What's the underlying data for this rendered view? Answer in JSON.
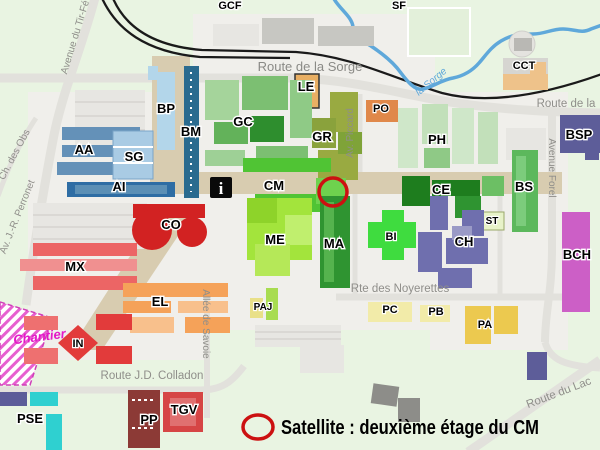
{
  "colors": {
    "grass": "#e9f4e2",
    "ground": "#f0efeb",
    "road": "#e2e1dc",
    "esplanade": "#d8ccb0",
    "railway": "#1a1a1a",
    "river": "#5fa8da",
    "marker": "#cc1111",
    "chantier": "#e318c8"
  },
  "buildings": {
    "GCF": {
      "label": "GCF"
    },
    "SF": {
      "label": "SF"
    },
    "CCT": {
      "label": "CCT",
      "color": "#eec28a"
    },
    "BP": {
      "label": "BP",
      "color": "#b3d6ea"
    },
    "BM": {
      "label": "BM",
      "color": "#2a6b8f"
    },
    "LE": {
      "label": "LE",
      "color": "#e9af63"
    },
    "PO": {
      "label": "PO",
      "color": "#e0884a"
    },
    "GC": {
      "label": "GC",
      "color": "#7cbf72"
    },
    "GR": {
      "label": "GR",
      "color": "#99aa41"
    },
    "PH": {
      "label": "PH",
      "color": "#c2e0ba"
    },
    "BSP": {
      "label": "BSP",
      "color": "#5d5d99"
    },
    "AA": {
      "label": "AA",
      "color": "#6491b8"
    },
    "SG": {
      "label": "SG",
      "color": "#a9cbe4"
    },
    "AI": {
      "label": "AI",
      "color": "#2e6da4"
    },
    "CM": {
      "label": "CM",
      "color": "#50c434"
    },
    "CE": {
      "label": "CE",
      "color": "#1e7d1e"
    },
    "BS": {
      "label": "BS",
      "color": "#5cb85c"
    },
    "ST": {
      "label": "ST",
      "color": "#e7f2c8"
    },
    "CO": {
      "label": "CO",
      "color": "#d22222"
    },
    "BI": {
      "label": "BI",
      "color": "#3fdc3f"
    },
    "CH": {
      "label": "CH",
      "color": "#6f6fae"
    },
    "BCH": {
      "label": "BCH",
      "color": "#cc5fc6"
    },
    "MX": {
      "label": "MX",
      "color": "#ec6565"
    },
    "ME": {
      "label": "ME",
      "color": "#a3e43c"
    },
    "MA": {
      "label": "MA",
      "color": "#2f9431"
    },
    "EL": {
      "label": "EL",
      "color": "#f5a259"
    },
    "IN": {
      "label": "IN",
      "color": "#e23b3b"
    },
    "PAJ": {
      "label": "PAJ",
      "color": "#e9e088"
    },
    "PC": {
      "label": "PC",
      "color": "#f2eba9"
    },
    "PB": {
      "label": "PB",
      "color": "#f2eba9"
    },
    "PA": {
      "label": "PA",
      "color": "#ecc94f"
    },
    "PSE": {
      "label": "PSE",
      "color": "#2fd0d0"
    },
    "PP": {
      "label": "PP",
      "color": "#8c3a36"
    },
    "TGV": {
      "label": "TGV",
      "color": "#d64545"
    }
  },
  "roads": {
    "tir_federal": {
      "label": "Avenue du Tir-Fé"
    },
    "ch_des_obs": {
      "label": "Ch. des Obs"
    },
    "perronet": {
      "label": "Av. J.-R. Perronet"
    },
    "sorge_route": {
      "label": "Route de la Sorge"
    },
    "route_de_la": {
      "label": "Route de la"
    },
    "av_piccard": {
      "label": "Av. Piccard"
    },
    "avenue_forel": {
      "label": "Avenue Forel"
    },
    "allee_savoie": {
      "label": "Allée de Savoie"
    },
    "colladon": {
      "label": "Route J.D. Colladon"
    },
    "noyerettes": {
      "label": "Rte des Noyerettes"
    },
    "route_du_lac": {
      "label": "Route du Lac"
    }
  },
  "river": {
    "label": "la Sorge"
  },
  "chantier": {
    "label": "Chantier"
  },
  "icons": {
    "information": "i"
  },
  "legend": {
    "text": "Satellite : deuxième étage du CM"
  }
}
